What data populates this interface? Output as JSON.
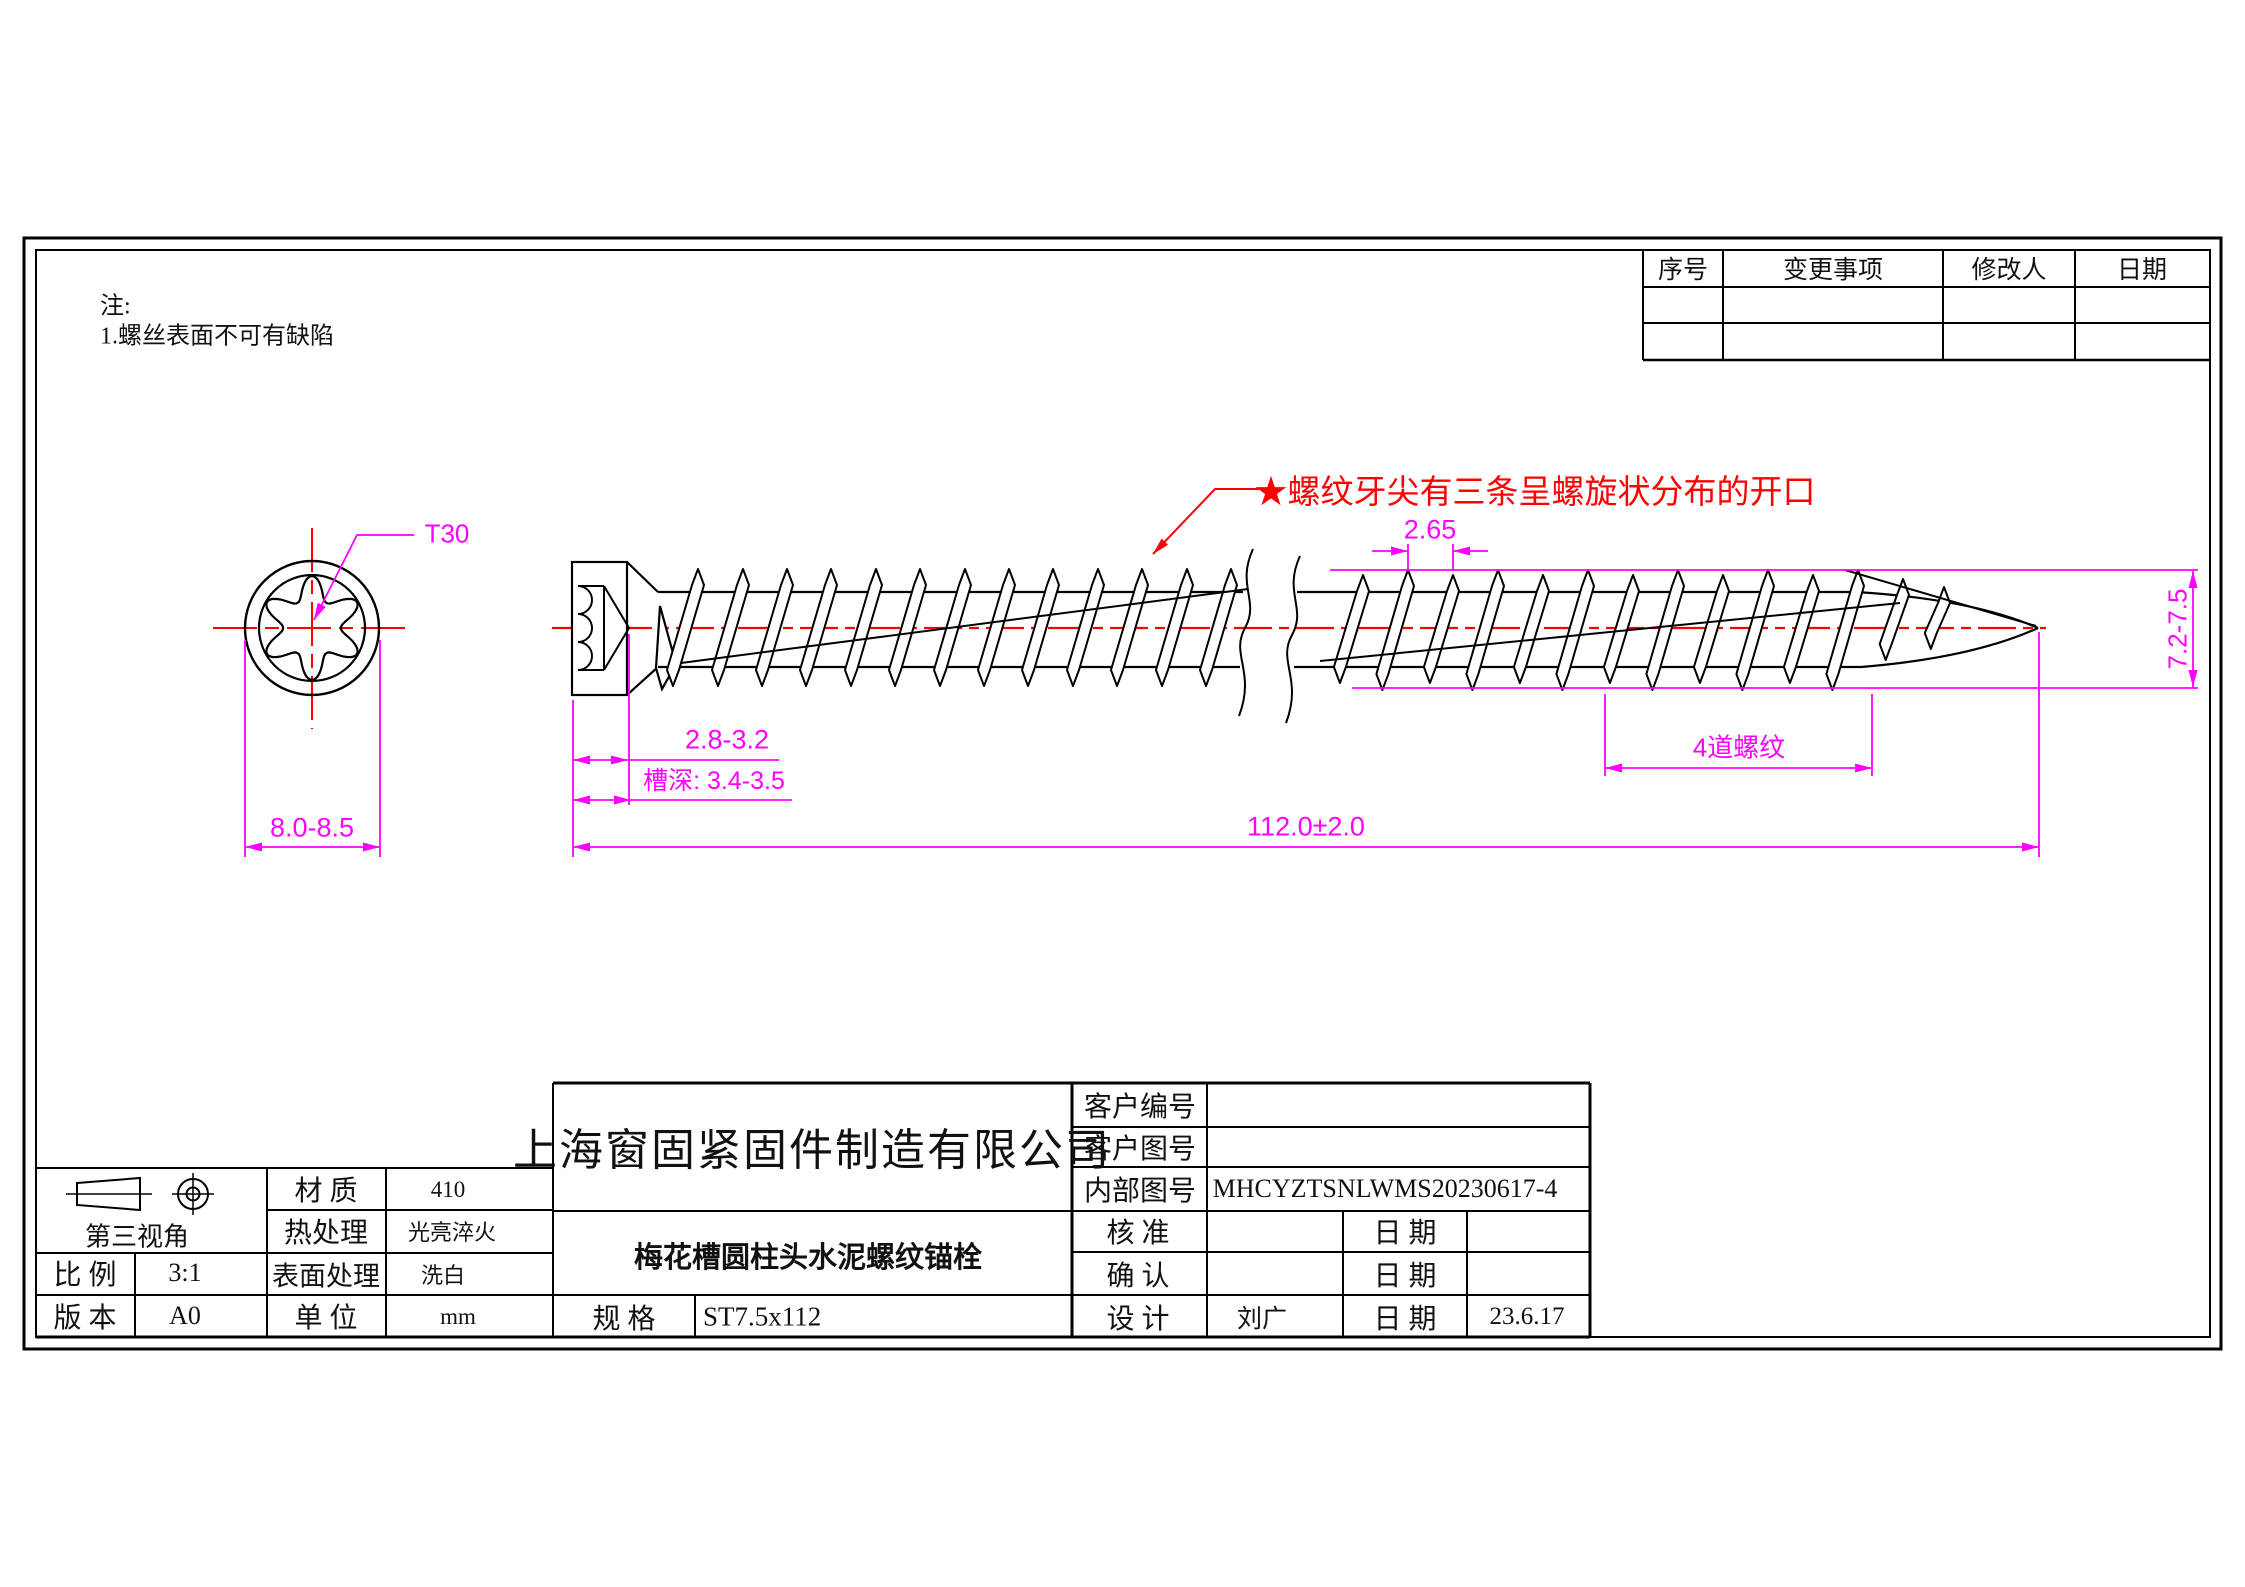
{
  "notes": {
    "title": "注:",
    "line1": "1.螺丝表面不可有缺陷"
  },
  "annotation": {
    "star_note": "★螺纹牙尖有三条呈螺旋状分布的开口"
  },
  "dimensions": {
    "torx_size": "T30",
    "head_diameter": "8.0-8.5",
    "head_height": "2.8-3.2",
    "recess_depth": "槽深: 3.4-3.5",
    "total_length": "112.0±2.0",
    "thread_pitch": "2.65",
    "thread_outer_diameter": "7.2-7.5",
    "thread_zone": "4道螺纹"
  },
  "revision_table": {
    "headers": [
      "序号",
      "变更事项",
      "修改人",
      "日期"
    ]
  },
  "title_block": {
    "company": "上海窗固紧固件制造有限公司",
    "product_name": "梅花槽圆柱头水泥螺纹锚栓",
    "projection": "第三视角",
    "scale_label": "比 例",
    "scale": "3:1",
    "version_label": "版 本",
    "version": "A0",
    "material_label": "材 质",
    "material": "410",
    "heat_label": "热处理",
    "heat": "光亮淬火",
    "surface_label": "表面处理",
    "surface": "洗白",
    "unit_label": "单 位",
    "unit": "mm",
    "spec_label": "规  格",
    "spec": "ST7.5x112",
    "customer_no_label": "客户编号",
    "customer_dwg_label": "客户图号",
    "internal_dwg_label": "内部图号",
    "internal_dwg": "MHCYZTSNLWMS20230617-4",
    "approve_label": "核 准",
    "confirm_label": "确 认",
    "design_label": "设 计",
    "date_label": "日 期",
    "designer": "刘广",
    "design_date": "23.6.17"
  },
  "colors": {
    "dimension": "#FF00FF",
    "centerline": "#FF0000",
    "line": "#000000"
  }
}
